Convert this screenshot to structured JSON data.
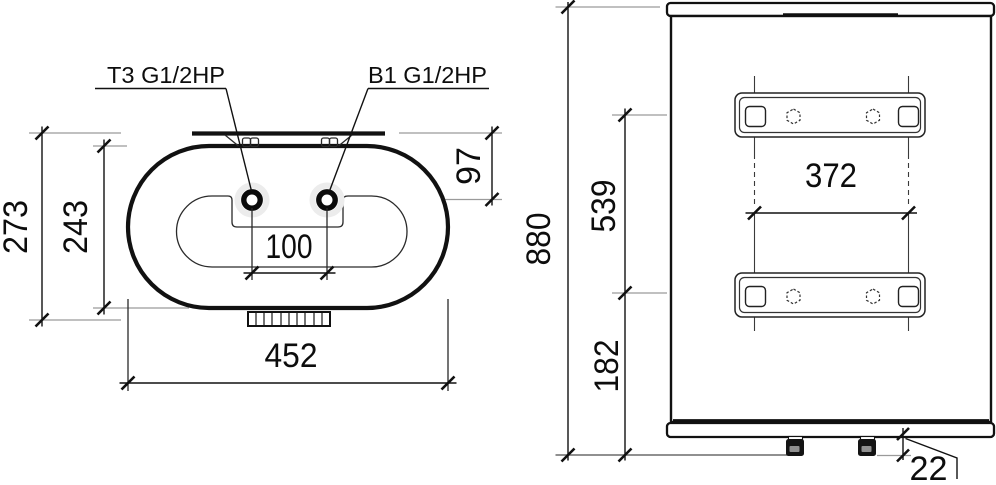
{
  "views": {
    "top": {
      "port_labels": {
        "t3": "T3 G1/2HP",
        "b1": "B1 G1/2HP"
      },
      "dims": {
        "overall_height": "273",
        "tank_height": "243",
        "port_offset": "97",
        "port_spacing": "100",
        "overall_width": "452"
      }
    },
    "rear": {
      "dims": {
        "overall_height": "880",
        "bracket_spacing": "539",
        "bracket_hole_spacing": "372",
        "bracket_to_bottom": "182",
        "pipe_protrusion": "22"
      }
    }
  },
  "colors": {
    "line": "#111111",
    "extension_line": "#9a9a9a",
    "background": "#ffffff"
  }
}
